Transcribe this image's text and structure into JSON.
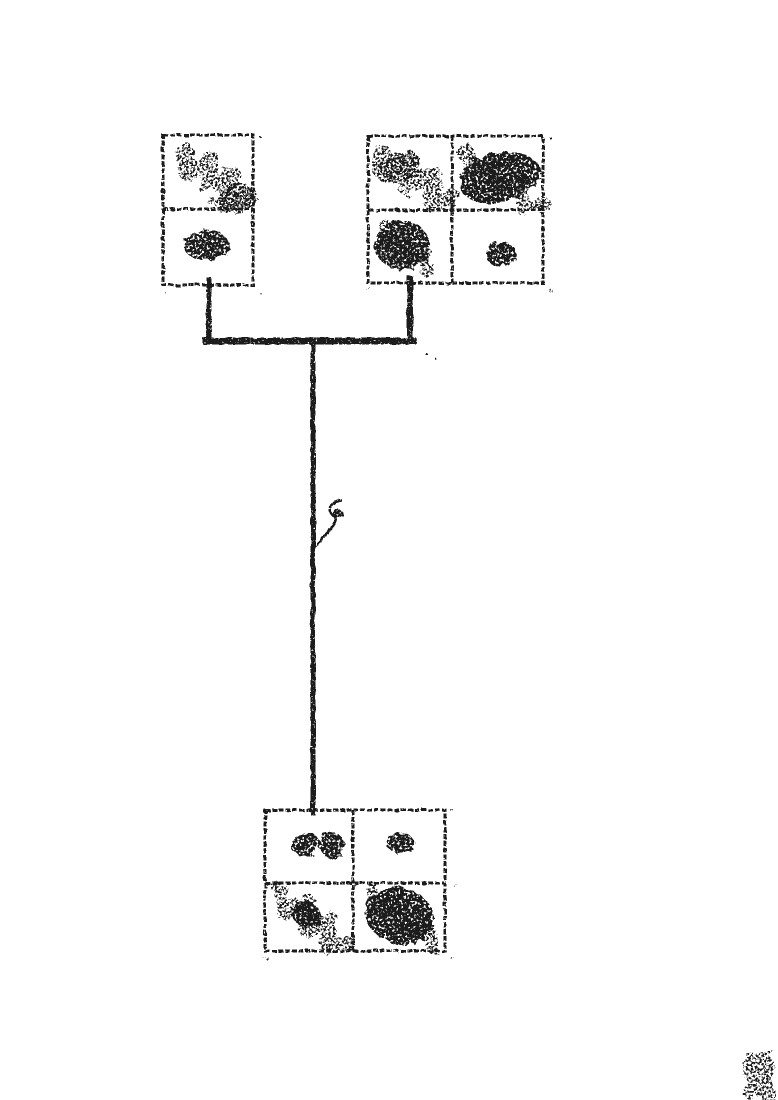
{
  "meta": {
    "background_color": "#ffffff",
    "ink_color": "#1a1a1a",
    "canvas_width": 778,
    "canvas_height": 1100,
    "frame_stroke_width": 3.2,
    "frame_dash": "5 1.8"
  },
  "diagram": {
    "kind": "hand-drawn-tree-of-panels",
    "nodes": [
      {
        "id": "left-parent",
        "x": 163,
        "y": 135,
        "w": 90,
        "h": 150,
        "row_dividers": [
          209
        ],
        "col_dividers": []
      },
      {
        "id": "right-parent",
        "x": 368,
        "y": 136,
        "w": 175,
        "h": 147,
        "row_dividers": [
          210
        ],
        "col_dividers": [
          452
        ]
      },
      {
        "id": "child",
        "x": 265,
        "y": 810,
        "w": 180,
        "h": 141,
        "row_dividers": [
          883
        ],
        "col_dividers": [
          353
        ]
      }
    ],
    "connectors": [
      {
        "x1": 209,
        "y1": 280,
        "x2": 209,
        "y2": 341,
        "w": 5
      },
      {
        "x1": 410,
        "y1": 279,
        "x2": 410,
        "y2": 341,
        "w": 6
      },
      {
        "x1": 206,
        "y1": 341,
        "x2": 413,
        "y2": 341,
        "w": 6.5
      },
      {
        "x1": 313,
        "y1": 341,
        "x2": 313,
        "y2": 813,
        "w": 5
      }
    ],
    "scribbles": [
      {
        "node": "left-parent",
        "shape": "zigzag",
        "x1": 180,
        "y1": 151,
        "x2": 243,
        "y2": 197,
        "amp": 13,
        "sw": 15,
        "segs": 6,
        "density": "light"
      },
      {
        "node": "left-parent",
        "shape": "ellipse",
        "cx": 231,
        "cy": 197,
        "rx": 21,
        "ry": 15,
        "rot": -20,
        "density": "light"
      },
      {
        "node": "left-parent",
        "shape": "ellipse",
        "cx": 204,
        "cy": 243,
        "rx": 23,
        "ry": 15,
        "rot": 0,
        "density": "dense"
      },
      {
        "node": "right-parent",
        "shape": "zigzag",
        "x1": 376,
        "y1": 152,
        "x2": 447,
        "y2": 197,
        "amp": 13,
        "sw": 16,
        "segs": 6,
        "density": "light"
      },
      {
        "node": "right-parent",
        "shape": "ellipse",
        "cx": 397,
        "cy": 165,
        "rx": 21,
        "ry": 15,
        "rot": -15,
        "density": "light"
      },
      {
        "node": "right-parent",
        "shape": "ellipse",
        "cx": 497,
        "cy": 176,
        "rx": 41,
        "ry": 25,
        "rot": -12,
        "density": "dense"
      },
      {
        "node": "right-parent",
        "shape": "zigzag",
        "x1": 461,
        "y1": 150,
        "x2": 539,
        "y2": 204,
        "amp": 12,
        "sw": 13,
        "segs": 6,
        "density": "light"
      },
      {
        "node": "right-parent",
        "shape": "ellipse",
        "cx": 400,
        "cy": 243,
        "rx": 27,
        "ry": 25,
        "rot": 0,
        "density": "dense"
      },
      {
        "node": "right-parent",
        "shape": "zigzag",
        "x1": 379,
        "y1": 224,
        "x2": 426,
        "y2": 266,
        "amp": 10,
        "sw": 11,
        "segs": 5,
        "density": "light"
      },
      {
        "node": "right-parent",
        "shape": "ellipse",
        "cx": 499,
        "cy": 252,
        "rx": 16,
        "ry": 12,
        "rot": 0,
        "density": "dense"
      },
      {
        "node": "child",
        "shape": "ellipse",
        "cx": 303,
        "cy": 842,
        "rx": 15,
        "ry": 12,
        "rot": 0,
        "density": "dense"
      },
      {
        "node": "child",
        "shape": "ellipse",
        "cx": 330,
        "cy": 843,
        "rx": 12,
        "ry": 13,
        "rot": 0,
        "density": "dense"
      },
      {
        "node": "child",
        "shape": "ellipse",
        "cx": 398,
        "cy": 841,
        "rx": 14,
        "ry": 10,
        "rot": 0,
        "density": "dense"
      },
      {
        "node": "child",
        "shape": "zigzag",
        "x1": 276,
        "y1": 891,
        "x2": 344,
        "y2": 944,
        "amp": 12,
        "sw": 14,
        "segs": 6,
        "density": "light"
      },
      {
        "node": "child",
        "shape": "ellipse",
        "cx": 306,
        "cy": 913,
        "rx": 16,
        "ry": 12,
        "rot": 30,
        "density": "dense"
      },
      {
        "node": "child",
        "shape": "ellipse",
        "cx": 398,
        "cy": 913,
        "rx": 35,
        "ry": 28,
        "rot": 15,
        "density": "dense"
      },
      {
        "node": "child",
        "shape": "zigzag",
        "x1": 367,
        "y1": 889,
        "x2": 433,
        "y2": 944,
        "amp": 10,
        "sw": 12,
        "segs": 5,
        "density": "light"
      }
    ],
    "marks": {
      "squiggle": {
        "path": "M341,500 C333,501 327,506 330,512 C333,517 337,516 336,521 C334,527 328,530 325,536 C322,541 318,544 313,548",
        "stroke_width": 2.5,
        "knot": {
          "cx": 336,
          "cy": 512,
          "rx": 5,
          "ry": 5
        }
      },
      "smudge": {
        "x": 743,
        "y": 1049,
        "w": 28,
        "h": 47
      },
      "specks": [
        {
          "x": 160,
          "y": 133
        },
        {
          "x": 256,
          "y": 133
        },
        {
          "x": 160,
          "y": 288
        },
        {
          "x": 256,
          "y": 288
        },
        {
          "x": 366,
          "y": 134
        },
        {
          "x": 546,
          "y": 134
        },
        {
          "x": 366,
          "y": 286
        },
        {
          "x": 546,
          "y": 286
        },
        {
          "x": 424,
          "y": 351
        },
        {
          "x": 433,
          "y": 356
        },
        {
          "x": 262,
          "y": 807
        },
        {
          "x": 448,
          "y": 807
        },
        {
          "x": 262,
          "y": 954
        },
        {
          "x": 448,
          "y": 954
        },
        {
          "x": 455,
          "y": 885
        }
      ]
    }
  }
}
